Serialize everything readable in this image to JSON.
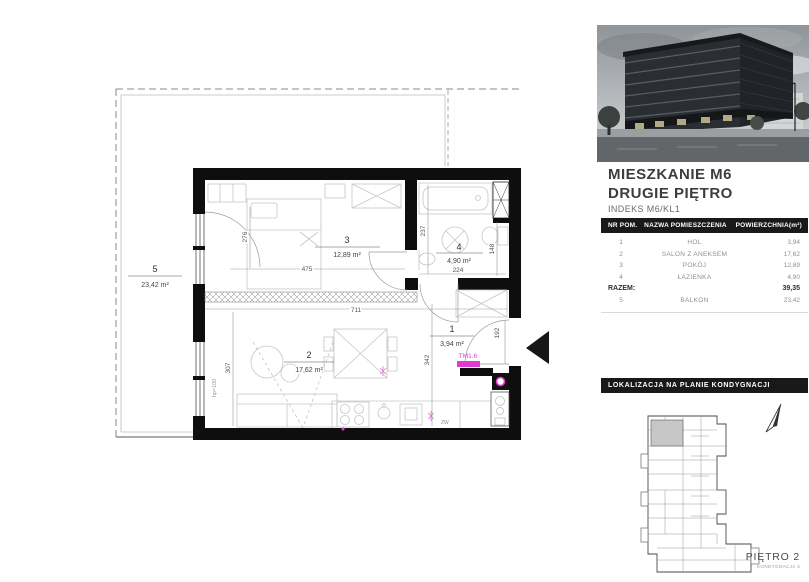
{
  "plan": {
    "accent": "#e23bd4",
    "rooms": {
      "r1": {
        "num": "1",
        "area": "3,94 m²"
      },
      "r2": {
        "num": "2",
        "area": "17,62 m²"
      },
      "r3": {
        "num": "3",
        "area": "12,89 m²"
      },
      "r4": {
        "num": "4",
        "area": "4,90 m²"
      },
      "r5": {
        "num": "5",
        "area": "23,42 m²"
      }
    },
    "dims": {
      "w475": "475",
      "h276": "276",
      "w711": "711",
      "h307": "307",
      "h237": "237",
      "w224": "224",
      "h148": "148",
      "h192": "192",
      "h342": "342"
    },
    "labels": {
      "radiator": "TM1.6",
      "zw": "ZW",
      "hp": "hp=100"
    }
  },
  "sidebar": {
    "title_line1": "MIESZKANIE M6",
    "title_line2": "DRUGIE PIĘTRO",
    "index_line": "INDEKS M6/KL1",
    "table": {
      "headers": [
        "NR POM.",
        "NAZWA POMIESZCZENIA",
        "POWIERZCHNIA(m²)"
      ],
      "rows": [
        {
          "nr": "1",
          "name": "HOL",
          "area": "3,94"
        },
        {
          "nr": "2",
          "name": "SALON Z ANEKSEM",
          "area": "17,62"
        },
        {
          "nr": "3",
          "name": "POKÓJ",
          "area": "12,89"
        },
        {
          "nr": "4",
          "name": "ŁAZIENKA",
          "area": "4,90"
        }
      ],
      "total_label": "RAZEM:",
      "total_value": "39,35",
      "balcony_row": {
        "nr": "5",
        "name": "BALKON",
        "area": "23,42"
      }
    },
    "location_header": "LOKALIZACJA NA PLANIE KONDYGNACJI",
    "floor_label": "PIĘTRO 2",
    "floor_sublabel": "KONDYGNACJA 3"
  }
}
